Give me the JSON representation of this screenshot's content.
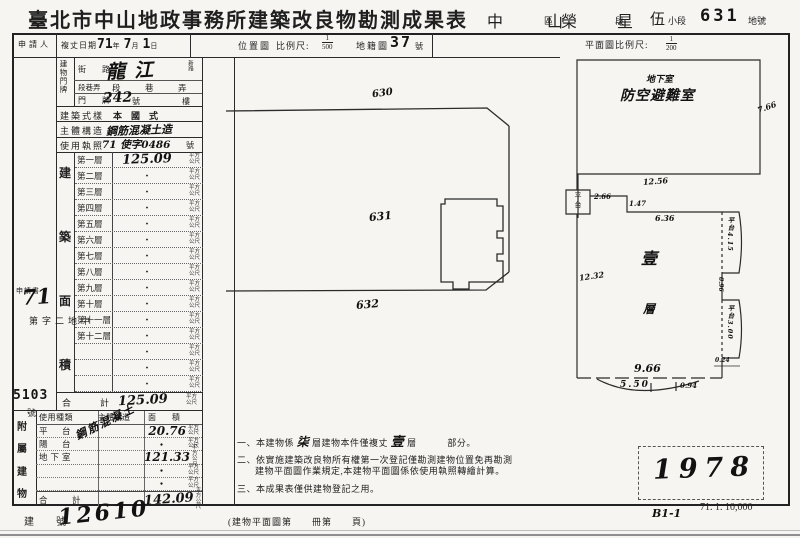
{
  "title": "臺北市中山地政事務所建築改良物勘測成果表",
  "admin": {
    "district": "中　山",
    "district_label": "區",
    "section": "榮　星",
    "section_label": "段",
    "subsection": "伍",
    "subsection_label": "小段",
    "parcel": "631",
    "parcel_label": "地號"
  },
  "header": {
    "applicant_label": "申請人",
    "survey_date": {
      "label": "複丈日期",
      "year": "71",
      "year_unit": "年",
      "month": "7",
      "month_unit": "月",
      "day": "1",
      "day_unit": "日"
    },
    "location_scale": {
      "label": "位置圖",
      "label2": "比例尺:",
      "num": "1",
      "den": "500"
    },
    "cadastre": {
      "label": "地籍圖",
      "no": "37",
      "suffix": "號"
    },
    "plan_scale": {
      "label": "平面圖比例尺:",
      "num": "1",
      "den": "200"
    }
  },
  "building": {
    "address_label_chars": "建物門牌",
    "street_label": "街　路",
    "street_value": "龍江",
    "street_side": "新路",
    "lane_label": "段巷弄",
    "lane_value": "段　巷　弄",
    "door_label": "門　牌",
    "door_value": "242",
    "door_suffix": "號",
    "floor_suffix": "樓",
    "style_label": "建築式樣",
    "style_value": "本　國　式",
    "structure_label": "主體構造",
    "structure_value": "鋼筋混凝土造",
    "license_label": "使用執照",
    "license_value": "71 使字0486",
    "license_suffix": "號"
  },
  "floors": {
    "area_label_chars": [
      "建",
      "築",
      "面",
      "積"
    ],
    "unit": [
      "平方",
      "公尺"
    ],
    "rows": [
      {
        "name": "第一層",
        "value": "125.09"
      },
      {
        "name": "第二層",
        "value": "・"
      },
      {
        "name": "第三層",
        "value": "・"
      },
      {
        "name": "第四層",
        "value": "・"
      },
      {
        "name": "第五層",
        "value": "・"
      },
      {
        "name": "第六層",
        "value": "・"
      },
      {
        "name": "第七層",
        "value": "・"
      },
      {
        "name": "第八層",
        "value": "・"
      },
      {
        "name": "第九層",
        "value": "・"
      },
      {
        "name": "第十層",
        "value": "・"
      },
      {
        "name": "第十一層",
        "value": "・"
      },
      {
        "name": "第十二層",
        "value": "・"
      },
      {
        "name": "",
        "value": "・"
      },
      {
        "name": "",
        "value": "・"
      },
      {
        "name": "",
        "value": "・"
      }
    ],
    "total_label": "合　計",
    "total_value": "125.09"
  },
  "application_stamp": {
    "text": "申請書",
    "number": "71",
    "prefix": "中地二字第",
    "no": "5103",
    "suffix": "號"
  },
  "annex": {
    "label_chars": [
      "附",
      "屬",
      "建",
      "物"
    ],
    "headers": [
      "使用種類",
      "主體構造",
      "面　　積"
    ],
    "structure_note": "鋼筋混凝土",
    "rows": [
      {
        "use": "平　台",
        "area": "20.76"
      },
      {
        "use": "陽　台",
        "area": "・"
      },
      {
        "use": "地下室",
        "area": "121.33"
      },
      {
        "use": "",
        "area": "・"
      },
      {
        "use": "",
        "area": "・"
      }
    ],
    "total_label": "合　計",
    "total_value": "142.09"
  },
  "location_map": {
    "street_parcel": "630",
    "parcel": "631",
    "south_parcel": "632"
  },
  "floor_plan": {
    "basement_sublabel": "地下室",
    "basement_label": "防空避難室",
    "dim_basement_right": "7.66",
    "dim_basement_bottom": "12.56",
    "platform_label_chars": [
      "平",
      "台"
    ],
    "dim_platform": "2.66",
    "dim_step": "1.47",
    "dim_top_inner": "6.36",
    "dim_left": "12.32",
    "floor_label_chars": [
      "壹",
      "層"
    ],
    "bay1_label": "平台4.15",
    "bay_gap": "0.96",
    "bay2_label": "平台3.00",
    "dim_corner": "0.24",
    "dim_bottom": "9.66",
    "dim_porch": "5.50",
    "dim_porch_right": "0.94"
  },
  "notes": {
    "n1a": "一、本建物係",
    "n1b": "柒",
    "n1c": "層建物本件僅複丈",
    "n1d": "壹",
    "n1e": "層",
    "n1f": "部分。",
    "n2a": "二、依實施建築改良物所有權第一次登記僅勘測建物位置免再勘測",
    "n2b": "建物平面圖作業規定,本建物平面圖係依使用執照轉繪計算。",
    "n3": "三、本成果表僅供建物登記之用。"
  },
  "footer": {
    "building_no_label": "建　號",
    "building_no": "12610",
    "plan_book": "(建物平面圖第　　冊第　　頁)",
    "stamp_no": "1978",
    "code": "B1-1",
    "print_code": "71. 1. 10,000"
  }
}
